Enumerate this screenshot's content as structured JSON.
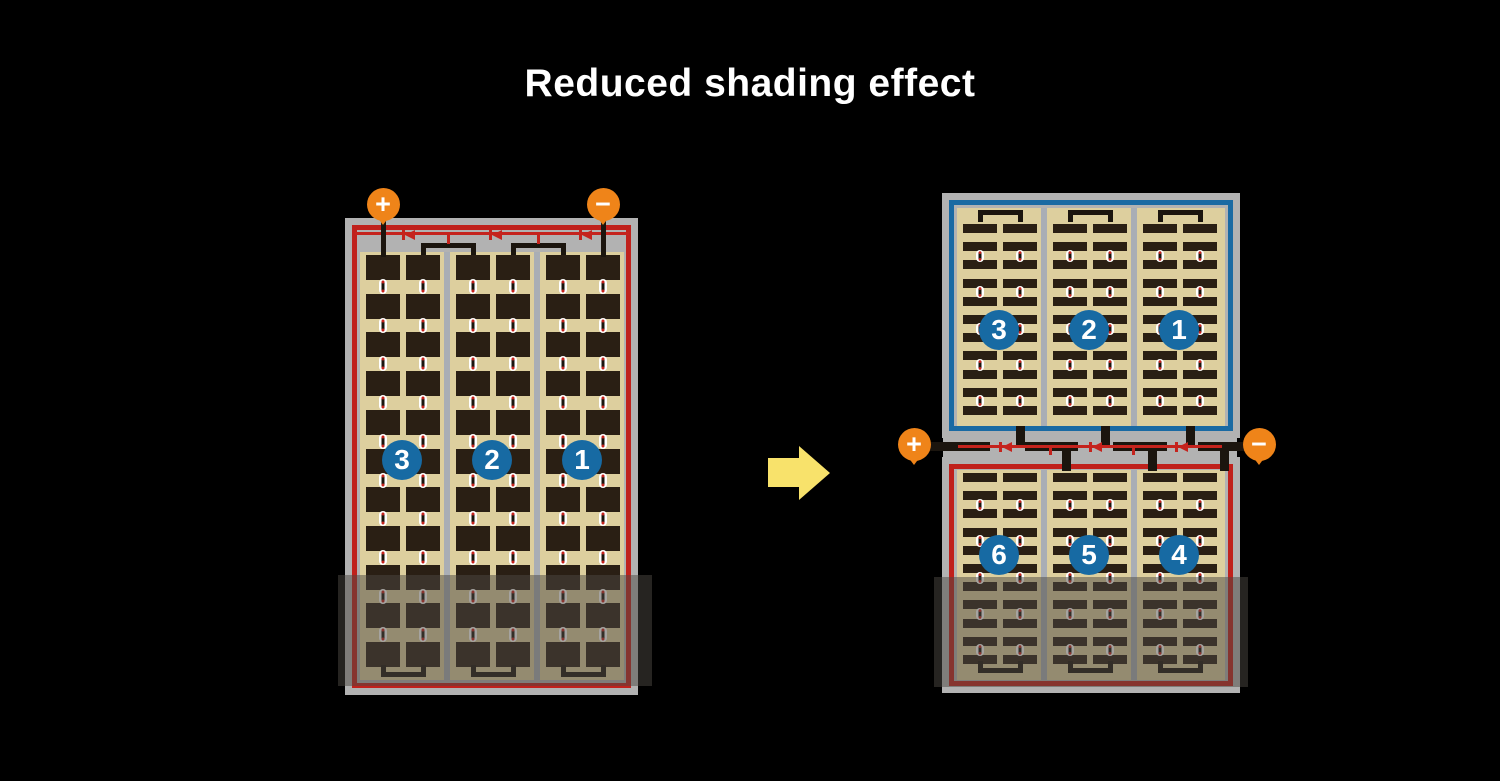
{
  "title": "Reduced shading effect",
  "colors": {
    "bg": "#000000",
    "frame": "#b2b2b2",
    "red": "#c0211c",
    "blue": "#1a6aa3",
    "tan": "#ddcf9e",
    "cell": "#2a1f14",
    "divider": "#a9aeb5",
    "labelBlue": "#176aa3",
    "orange": "#ef8419",
    "diodeRed": "#c5231d",
    "wire": "#1b150e",
    "arrow": "#f8e26b",
    "overlay": "rgba(75,72,66,0.5)"
  },
  "left_panel": {
    "terminals": {
      "positive": "+",
      "negative": "−"
    },
    "string_labels": [
      "3",
      "2",
      "1"
    ],
    "strings": 3,
    "columns_per_string": 2,
    "rows": 11,
    "bypass_diodes": 3,
    "shading": "bottom"
  },
  "right_panel": {
    "terminals": {
      "positive": "+",
      "negative": "−"
    },
    "top_string_labels": [
      "3",
      "2",
      "1"
    ],
    "bottom_string_labels": [
      "6",
      "5",
      "4"
    ],
    "strings_per_half": 3,
    "columns_per_string": 2,
    "rows_per_half": 11,
    "bypass_diodes": 3,
    "shading": "bottom"
  },
  "arrow": {
    "direction": "right"
  }
}
